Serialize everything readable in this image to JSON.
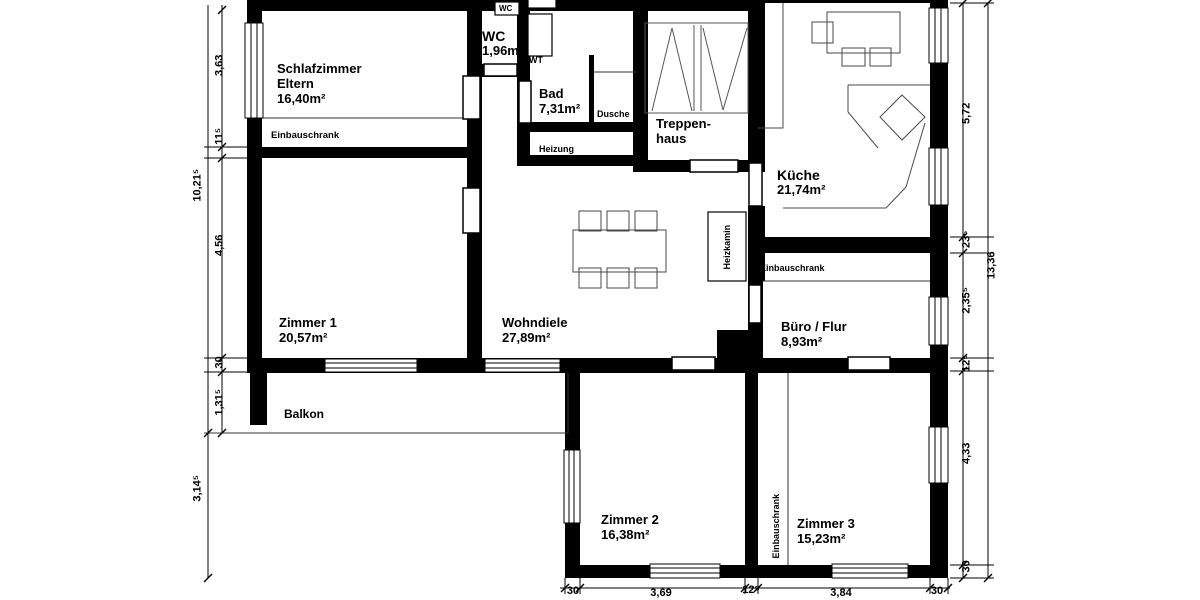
{
  "rooms": {
    "schlafzimmer": {
      "name": "Schlafzimmer",
      "name2": "Eltern",
      "area": "16,40m²"
    },
    "wc": {
      "name": "WC",
      "area": "1,96m²"
    },
    "bad": {
      "name": "Bad",
      "area": "7,31m²"
    },
    "treppenhaus": {
      "name": "Treppen-",
      "name2": "haus"
    },
    "kueche": {
      "name": "Küche",
      "area": "21,74m²"
    },
    "zimmer1": {
      "name": "Zimmer 1",
      "area": "20,57m²"
    },
    "wohndiele": {
      "name": "Wohndiele",
      "area": "27,89m²"
    },
    "buero": {
      "name": "Büro / Flur",
      "area": "8,93m²"
    },
    "balkon": {
      "name": "Balkon"
    },
    "zimmer2": {
      "name": "Zimmer 2",
      "area": "16,38m²"
    },
    "zimmer3": {
      "name": "Zimmer 3",
      "area": "15,23m²"
    }
  },
  "fixtures": {
    "wc_cistern": "WC",
    "wt": "WT",
    "dusche": "Dusche",
    "heizung": "Heizung",
    "heizkamin": "Heizkamin",
    "einbauschrank_schlafzimmer": "Einbauschrank",
    "einbauschrank_buero": "Einbauschrank",
    "einbauschrank_zimmer3": "Einbauschrank"
  },
  "dims": {
    "left_outer": {
      "upper": "10,21⁵",
      "lower": "3,14⁵"
    },
    "left_inner": {
      "d1": "3,63",
      "d2": "11⁵",
      "d3": "4,56",
      "d4": "30",
      "d5": "1,31⁵"
    },
    "right_outer": {
      "total": "13,36"
    },
    "right_inner": {
      "d1": "5,72",
      "d2": "23⁵",
      "d3": "2,35⁵",
      "d4": "12⁵",
      "d5": "4,33",
      "d6": "30"
    },
    "bottom": {
      "d1": "30",
      "d2": "3,69",
      "d3": "12⁵",
      "d4": "3,84",
      "d5": "30"
    }
  },
  "colors": {
    "wall": "#000000",
    "furniture_line": "#4a4a4a",
    "background": "#ffffff"
  }
}
